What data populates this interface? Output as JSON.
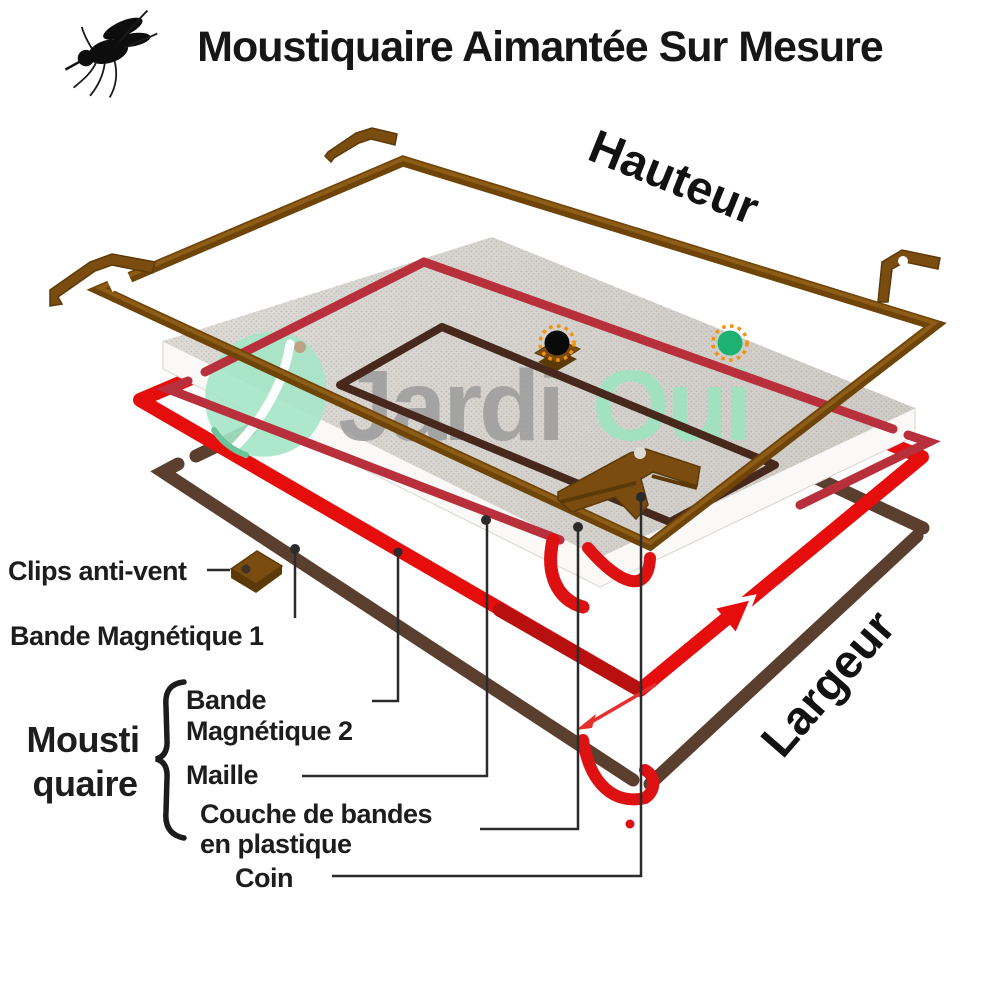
{
  "title": {
    "text": "Moustiquaire Aimantée Sur Mesure"
  },
  "dimension_labels": {
    "height": "Hauteur",
    "width": "Largeur"
  },
  "logo": {
    "part1": "Jardi",
    "part2": "Oui"
  },
  "labels": {
    "clips": "Clips anti-vent",
    "magnetic_band_1": "Bande Magnétique 1",
    "moustiquaire_line1": "Mousti",
    "moustiquaire_line2": "quaire",
    "magnetic_band_2_line1": "Bande",
    "magnetic_band_2_line2": "Magnétique 2",
    "mesh": "Maille",
    "plastic_line1": "Couche de bandes",
    "plastic_line2": "en plastique",
    "corner": "Coin"
  },
  "icons": {
    "mosquito": "mosquito-icon",
    "leaf": "leaf-icon",
    "hotspot_black": "black-hotspot-dot",
    "hotspot_green": "green-hotspot-dot"
  },
  "colors": {
    "frame_brown": "#7a4c10",
    "frame_brown_highlight": "#8d5c17",
    "frame_brown_shadow": "#5c3a08",
    "magnetic_red": "#e60d0d",
    "crimson_frame": "#b8303c",
    "dark_band": "#5a3f2e",
    "inner_dark_frame": "#46291c",
    "mesh_gray": "#dedbd7",
    "mesh_dot": "#c3c0bb",
    "mesh_edge_white": "#faf9f7",
    "logo_gray": "#9c9c9c",
    "logo_mint": "#9fe4c1",
    "leaf_mint": "#a5e5c6",
    "hotspot_green": "#1db272",
    "hotspot_black": "#0a0a0a",
    "hotspot_ring_orange": "#f5920b",
    "text_dark": "#1a1a1a"
  }
}
